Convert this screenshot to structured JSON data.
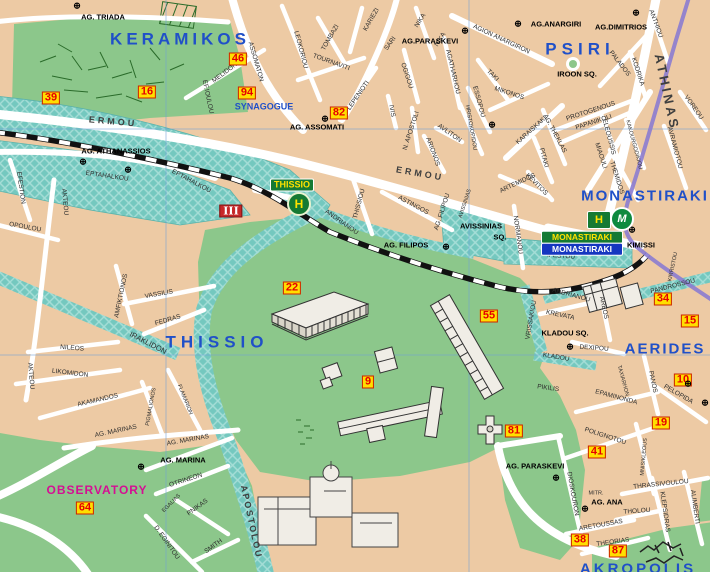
{
  "colors": {
    "land": "#edcaa4",
    "park": "#8cc78b",
    "pedestrian": "#74c8bf",
    "pedestrian_hatch": "#a6ded7",
    "street": "#ffffff",
    "area_label": "#2050c8",
    "street_label": "#2d2d2d",
    "poi_label": "#000000",
    "observatory": "#d40f93",
    "badge_bg": "#ffdf00",
    "badge_text": "#e60000",
    "badge_border": "#cc2200",
    "rail": "#111111",
    "metro_line": "#8b7cd0",
    "grid": "#6f9fd8",
    "station_green": "#157a33",
    "station_yellow": "#ffe100",
    "station_blue": "#1536c0"
  },
  "areas": [
    {
      "label": "KERAMIKOS",
      "x": 180,
      "y": 39,
      "size": 17,
      "ls": 4
    },
    {
      "label": "PSIRI",
      "x": 580,
      "y": 49,
      "size": 17,
      "ls": 5
    },
    {
      "label": "THISSIO",
      "x": 217,
      "y": 342,
      "size": 17,
      "ls": 5
    },
    {
      "label": "MONASTIRAKI",
      "x": 645,
      "y": 196,
      "size": 15,
      "ls": 2
    },
    {
      "label": "AERIDES",
      "x": 665,
      "y": 349,
      "size": 15,
      "ls": 2
    },
    {
      "label": "AKROPOLIS",
      "x": 638,
      "y": 569,
      "size": 15,
      "ls": 3
    },
    {
      "label": "SYNAGOGUE",
      "x": 264,
      "y": 107,
      "size": 9,
      "ls": 0
    }
  ],
  "streets": [
    {
      "label": "ERMOU",
      "x": 113,
      "y": 122,
      "rot": 5,
      "size": 9,
      "cls": "bstreet",
      "ls": 3
    },
    {
      "label": "ERMOU",
      "x": 420,
      "y": 174,
      "rot": 10,
      "size": 9,
      "cls": "bstreet",
      "ls": 3
    },
    {
      "label": "ATHINAS",
      "x": 667,
      "y": 92,
      "rot": 78,
      "size": 13,
      "cls": "bstreet",
      "ls": 3
    },
    {
      "label": "ASSOMATON",
      "x": 255,
      "y": 62,
      "rot": 74
    },
    {
      "label": "MELIDONI",
      "x": 226,
      "y": 73,
      "rot": -37
    },
    {
      "label": "EF.IOULOU",
      "x": 207,
      "y": 97,
      "rot": 78
    },
    {
      "label": "LEOKORIOU",
      "x": 300,
      "y": 50,
      "rot": 75
    },
    {
      "label": "TOMBAZI",
      "x": 331,
      "y": 38,
      "rot": -60
    },
    {
      "label": "KARIEZI",
      "x": 372,
      "y": 20,
      "rot": -60
    },
    {
      "label": "SARI",
      "x": 391,
      "y": 44,
      "rot": -55
    },
    {
      "label": "NIKA",
      "x": 421,
      "y": 21,
      "rot": -58
    },
    {
      "label": "NIKA",
      "x": 441,
      "y": 40,
      "rot": -58
    },
    {
      "label": "TOURNAVITI",
      "x": 331,
      "y": 63,
      "rot": 20
    },
    {
      "label": "OGIGOU",
      "x": 406,
      "y": 76,
      "rot": 72
    },
    {
      "label": "LEPENIOTI",
      "x": 359,
      "y": 96,
      "rot": -55
    },
    {
      "label": "IVIS",
      "x": 391,
      "y": 111,
      "rot": 80
    },
    {
      "label": "AGATHARHOU",
      "x": 452,
      "y": 72,
      "rot": 77
    },
    {
      "label": "N. APOSTOLI",
      "x": 412,
      "y": 131,
      "rot": -72
    },
    {
      "label": "ARIONOS",
      "x": 432,
      "y": 152,
      "rot": 70
    },
    {
      "label": "AVLITON",
      "x": 449,
      "y": 134,
      "rot": 35
    },
    {
      "label": "HRISTOKOPIDOU",
      "x": 470,
      "y": 128,
      "rot": 80,
      "size": 5.5
    },
    {
      "label": "KARAISKAKI",
      "x": 532,
      "y": 131,
      "rot": -42
    },
    {
      "label": "AG. THEKLAS",
      "x": 554,
      "y": 134,
      "rot": 62
    },
    {
      "label": "PITAKI",
      "x": 543,
      "y": 158,
      "rot": 75
    },
    {
      "label": "ARTEMIDOS",
      "x": 518,
      "y": 184,
      "rot": -25
    },
    {
      "label": "KEVITOS",
      "x": 536,
      "y": 185,
      "rot": 45
    },
    {
      "label": "AGION ANARGIRON",
      "x": 501,
      "y": 40,
      "rot": 25
    },
    {
      "label": "TAKI",
      "x": 492,
      "y": 76,
      "rot": 45
    },
    {
      "label": "ESSOPOU",
      "x": 478,
      "y": 102,
      "rot": 75
    },
    {
      "label": "MIKONOS",
      "x": 509,
      "y": 94,
      "rot": 18
    },
    {
      "label": "PROTOGENOUS",
      "x": 591,
      "y": 112,
      "rot": -18
    },
    {
      "label": "PAPANIKOLI",
      "x": 594,
      "y": 123,
      "rot": -18
    },
    {
      "label": "ELEOUSSIS",
      "x": 608,
      "y": 137,
      "rot": 75
    },
    {
      "label": "KAKOURGODIKIOU",
      "x": 633,
      "y": 145,
      "rot": 75,
      "size": 5.5
    },
    {
      "label": "MIAOULI",
      "x": 600,
      "y": 156,
      "rot": 72
    },
    {
      "label": "THEMIDOS",
      "x": 616,
      "y": 178,
      "rot": 72
    },
    {
      "label": "PALADOS",
      "x": 619,
      "y": 64,
      "rot": 52
    },
    {
      "label": "KODRIKA",
      "x": 637,
      "y": 72,
      "rot": 72
    },
    {
      "label": "ANTHIOU",
      "x": 655,
      "y": 24,
      "rot": 70
    },
    {
      "label": "VOREOU",
      "x": 693,
      "y": 108,
      "rot": 55
    },
    {
      "label": "AVRAMIOTOU",
      "x": 674,
      "y": 148,
      "rot": 75
    },
    {
      "label": "EPTAHALKOU",
      "x": 107,
      "y": 177,
      "rot": 8
    },
    {
      "label": "EPTAHALKOU",
      "x": 191,
      "y": 182,
      "rot": 28
    },
    {
      "label": "EFESTION",
      "x": 20,
      "y": 188,
      "rot": 82
    },
    {
      "label": "OPOULOU",
      "x": 25,
      "y": 228,
      "rot": 10
    },
    {
      "label": "AKTEOU",
      "x": 64,
      "y": 202,
      "rot": 85
    },
    {
      "label": "THISSIOU",
      "x": 360,
      "y": 204,
      "rot": -75
    },
    {
      "label": "ANDRIANOU",
      "x": 341,
      "y": 223,
      "rot": 35
    },
    {
      "label": "ASTINGOS",
      "x": 413,
      "y": 206,
      "rot": 28
    },
    {
      "label": "AG. FILIPOU",
      "x": 443,
      "y": 212,
      "rot": -72
    },
    {
      "label": "AVISSINIAS",
      "x": 466,
      "y": 204,
      "rot": -72,
      "size": 5.5
    },
    {
      "label": "NORMANOU",
      "x": 517,
      "y": 235,
      "rot": 82
    },
    {
      "label": "IFESTOU",
      "x": 561,
      "y": 257,
      "rot": 4
    },
    {
      "label": "KREVATA",
      "x": 560,
      "y": 316,
      "rot": 12
    },
    {
      "label": "KLADOU",
      "x": 556,
      "y": 358,
      "rot": 9
    },
    {
      "label": "VRISSAKIOU",
      "x": 532,
      "y": 320,
      "rot": -80
    },
    {
      "label": "ANDRIANOU",
      "x": 571,
      "y": 296,
      "rot": 15
    },
    {
      "label": "PIKILIS",
      "x": 548,
      "y": 389,
      "rot": 8
    },
    {
      "label": "DEXIPOU",
      "x": 594,
      "y": 349,
      "rot": 4
    },
    {
      "label": "AREOS",
      "x": 603,
      "y": 308,
      "rot": 78
    },
    {
      "label": "PANDROSSOU",
      "x": 673,
      "y": 287,
      "rot": -14
    },
    {
      "label": "KIRRISTOU",
      "x": 674,
      "y": 267,
      "rot": -78,
      "size": 5.5
    },
    {
      "label": "PANOS",
      "x": 652,
      "y": 382,
      "rot": 78
    },
    {
      "label": "PELOPIDA",
      "x": 678,
      "y": 395,
      "rot": 30
    },
    {
      "label": "EPAMINONDA",
      "x": 616,
      "y": 398,
      "rot": 15
    },
    {
      "label": "TAXIARHON",
      "x": 622,
      "y": 381,
      "rot": 75,
      "size": 5.5
    },
    {
      "label": "POLIGNOTOU",
      "x": 605,
      "y": 437,
      "rot": 18
    },
    {
      "label": "DIOSKOURON",
      "x": 572,
      "y": 494,
      "rot": 80
    },
    {
      "label": "MNISIKLEOUS",
      "x": 645,
      "y": 457,
      "rot": -85,
      "size": 5.5
    },
    {
      "label": "KLEPSIDRAS",
      "x": 664,
      "y": 512,
      "rot": 82
    },
    {
      "label": "ALIMBERTI",
      "x": 694,
      "y": 507,
      "rot": 82
    },
    {
      "label": "THRASSIVOULOU",
      "x": 661,
      "y": 485,
      "rot": -6
    },
    {
      "label": "MITR.",
      "x": 596,
      "y": 494,
      "rot": 0,
      "size": 5.5
    },
    {
      "label": "THOLOU",
      "x": 637,
      "y": 512,
      "rot": -4
    },
    {
      "label": "ARETOUSSAS",
      "x": 601,
      "y": 526,
      "rot": -10
    },
    {
      "label": "THEORIAS",
      "x": 613,
      "y": 543,
      "rot": -8
    },
    {
      "label": "VASSILIS",
      "x": 159,
      "y": 295,
      "rot": -10
    },
    {
      "label": "FEDRAS",
      "x": 168,
      "y": 321,
      "rot": -16
    },
    {
      "label": "AMFIKTIONOS",
      "x": 122,
      "y": 296,
      "rot": -78
    },
    {
      "label": "IRAKLIDON",
      "x": 148,
      "y": 343,
      "rot": 27,
      "size": 7.5
    },
    {
      "label": "NILEOS",
      "x": 72,
      "y": 349,
      "rot": 5
    },
    {
      "label": "LIKOMIDON",
      "x": 70,
      "y": 374,
      "rot": 7
    },
    {
      "label": "AKAMANDOS",
      "x": 98,
      "y": 401,
      "rot": -13
    },
    {
      "label": "AKTEOU",
      "x": 30,
      "y": 376,
      "rot": 85
    },
    {
      "label": "PIGMALIONOS",
      "x": 152,
      "y": 407,
      "rot": -80,
      "size": 5.5
    },
    {
      "label": "FLAMARION",
      "x": 184,
      "y": 400,
      "rot": 68,
      "size": 5.5
    },
    {
      "label": "AG. MARINAS",
      "x": 116,
      "y": 432,
      "rot": -12
    },
    {
      "label": "AG. MARINAS",
      "x": 188,
      "y": 441,
      "rot": -10
    },
    {
      "label": "OTRINEON",
      "x": 186,
      "y": 481,
      "rot": -18
    },
    {
      "label": "EGALIAS",
      "x": 172,
      "y": 504,
      "rot": -45,
      "size": 5.5
    },
    {
      "label": "PNIKAS",
      "x": 198,
      "y": 508,
      "rot": -36
    },
    {
      "label": "D. EGINITOU",
      "x": 166,
      "y": 543,
      "rot": 55
    },
    {
      "label": "SMITH",
      "x": 214,
      "y": 547,
      "rot": -36
    },
    {
      "label": "APOSTOLOU",
      "x": 251,
      "y": 522,
      "rot": 78,
      "size": 9,
      "cls": "bstreet",
      "ls": 2
    }
  ],
  "pois": [
    {
      "label": "AG. TRIADA",
      "x": 103,
      "y": 17
    },
    {
      "label": "AG.PARASKEVI",
      "x": 430,
      "y": 41
    },
    {
      "label": "AG.ANARGIRI",
      "x": 556,
      "y": 24
    },
    {
      "label": "AG.DIMITRIOS",
      "x": 621,
      "y": 27
    },
    {
      "label": "IROON SQ.",
      "x": 577,
      "y": 74
    },
    {
      "label": "AG. ASSOMATI",
      "x": 317,
      "y": 127
    },
    {
      "label": "AG. ATHANASSIOS",
      "x": 116,
      "y": 151
    },
    {
      "label": "AVISSINIAS",
      "x": 481,
      "y": 226
    },
    {
      "label": "SQ.",
      "x": 500,
      "y": 237
    },
    {
      "label": "AG. FILIPOS",
      "x": 406,
      "y": 245
    },
    {
      "label": "KIMISSI",
      "x": 641,
      "y": 245
    },
    {
      "label": "KLADOU SQ.",
      "x": 565,
      "y": 333
    },
    {
      "label": "AG. PARASKEVI",
      "x": 535,
      "y": 466
    },
    {
      "label": "AG. ANA",
      "x": 607,
      "y": 502
    },
    {
      "label": "AG. MARINA",
      "x": 183,
      "y": 460
    },
    {
      "label": "OBSERVATORY",
      "x": 97,
      "y": 490,
      "size": 12,
      "cls": "magenta"
    }
  ],
  "badges": [
    {
      "label": "39",
      "x": 51,
      "y": 98
    },
    {
      "label": "16",
      "x": 147,
      "y": 92
    },
    {
      "label": "46",
      "x": 238,
      "y": 59
    },
    {
      "label": "94",
      "x": 247,
      "y": 93
    },
    {
      "label": "82",
      "x": 339,
      "y": 113
    },
    {
      "label": "22",
      "x": 292,
      "y": 288
    },
    {
      "label": "55",
      "x": 489,
      "y": 316
    },
    {
      "label": "9",
      "x": 368,
      "y": 382
    },
    {
      "label": "34",
      "x": 663,
      "y": 299
    },
    {
      "label": "15",
      "x": 690,
      "y": 321
    },
    {
      "label": "10",
      "x": 683,
      "y": 380
    },
    {
      "label": "19",
      "x": 661,
      "y": 423
    },
    {
      "label": "81",
      "x": 514,
      "y": 431
    },
    {
      "label": "41",
      "x": 597,
      "y": 452
    },
    {
      "label": "64",
      "x": 85,
      "y": 508
    },
    {
      "label": "38",
      "x": 580,
      "y": 540
    },
    {
      "label": "87",
      "x": 618,
      "y": 551
    },
    {
      "label": "III",
      "x": 231,
      "y": 211,
      "cls": "roman"
    }
  ],
  "churches": [
    {
      "x": 77,
      "y": 6
    },
    {
      "x": 465,
      "y": 31
    },
    {
      "x": 518,
      "y": 24
    },
    {
      "x": 636,
      "y": 13
    },
    {
      "x": 492,
      "y": 125
    },
    {
      "x": 325,
      "y": 119
    },
    {
      "x": 83,
      "y": 162
    },
    {
      "x": 128,
      "y": 170
    },
    {
      "x": 446,
      "y": 247
    },
    {
      "x": 632,
      "y": 230
    },
    {
      "x": 570,
      "y": 347
    },
    {
      "x": 688,
      "y": 384
    },
    {
      "x": 705,
      "y": 403
    },
    {
      "x": 585,
      "y": 509
    },
    {
      "x": 556,
      "y": 478
    },
    {
      "x": 141,
      "y": 467
    }
  ],
  "stations": {
    "thissio": {
      "name": "THISSIO",
      "symbol": "H"
    },
    "monastiraki": {
      "isap_label": "MONASTIRAKI",
      "metro_label": "MONASTIRAKI",
      "symbol": "H",
      "metro_symbol": "M"
    }
  }
}
